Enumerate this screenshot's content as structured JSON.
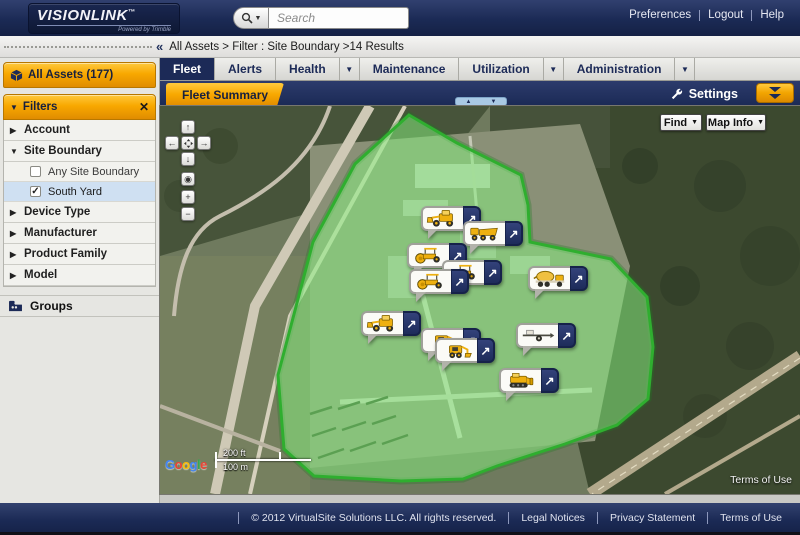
{
  "topbar": {
    "brand": "VISIONLINK",
    "brand_tm": "™",
    "brand_sub": "Powered by Trimble",
    "search_placeholder": "Search",
    "links": [
      {
        "label": "Preferences"
      },
      {
        "label": "Logout"
      },
      {
        "label": "Help"
      }
    ]
  },
  "breadcrumb": {
    "text": "All Assets > Filter :  Site Boundary  >14 Results"
  },
  "sidebar": {
    "all_assets": {
      "label": "All Assets (177)"
    },
    "filters": {
      "label": "Filters"
    },
    "sections": [
      {
        "label": "Account",
        "expanded": false
      },
      {
        "label": "Site Boundary",
        "expanded": true,
        "options": [
          {
            "label": "Any Site Boundary",
            "checked": false,
            "selected": false
          },
          {
            "label": "South Yard",
            "checked": true,
            "selected": true
          }
        ]
      },
      {
        "label": "Device Type",
        "expanded": false
      },
      {
        "label": "Manufacturer",
        "expanded": false
      },
      {
        "label": "Product Family",
        "expanded": false
      },
      {
        "label": "Model",
        "expanded": false
      }
    ],
    "groups": {
      "label": "Groups"
    }
  },
  "tabs": [
    {
      "label": "Fleet",
      "active": true,
      "dropdown": false
    },
    {
      "label": "Alerts",
      "active": false,
      "dropdown": false
    },
    {
      "label": "Health",
      "active": false,
      "dropdown": true
    },
    {
      "label": "Maintenance",
      "active": false,
      "dropdown": false
    },
    {
      "label": "Utilization",
      "active": false,
      "dropdown": true
    },
    {
      "label": "Administration",
      "active": false,
      "dropdown": true
    }
  ],
  "subbar": {
    "subtab": "Fleet Summary",
    "settings": "Settings"
  },
  "map": {
    "find": "Find",
    "map_info": "Map Info",
    "scale": {
      "imperial": "200 ft",
      "metric": "100 m"
    },
    "attribution": "Google",
    "terms": "Terms of Use",
    "assets": [
      {
        "type": "wheel-loader",
        "x": 261,
        "y": 100
      },
      {
        "type": "dump-truck",
        "x": 303,
        "y": 115
      },
      {
        "type": "roller",
        "x": 247,
        "y": 137
      },
      {
        "type": "roller",
        "x": 282,
        "y": 154
      },
      {
        "type": "roller",
        "x": 249,
        "y": 163
      },
      {
        "type": "mixer-truck",
        "x": 368,
        "y": 160
      },
      {
        "type": "wheel-loader",
        "x": 201,
        "y": 205
      },
      {
        "type": "skid-steer",
        "x": 261,
        "y": 222
      },
      {
        "type": "skid-steer",
        "x": 275,
        "y": 232
      },
      {
        "type": "trailer",
        "x": 356,
        "y": 217
      },
      {
        "type": "dozer",
        "x": 339,
        "y": 262
      }
    ]
  },
  "footer": {
    "copyright": "© 2012 VirtualSite Solutions LLC. All rights reserved.",
    "links": [
      {
        "label": "Legal Notices"
      },
      {
        "label": "Privacy Statement"
      },
      {
        "label": "Terms of Use"
      }
    ]
  },
  "colors": {
    "navy": "#1c2a57",
    "orange": "#f8a800",
    "site_fill": "#86f07e",
    "site_stroke": "#2fae2f"
  }
}
